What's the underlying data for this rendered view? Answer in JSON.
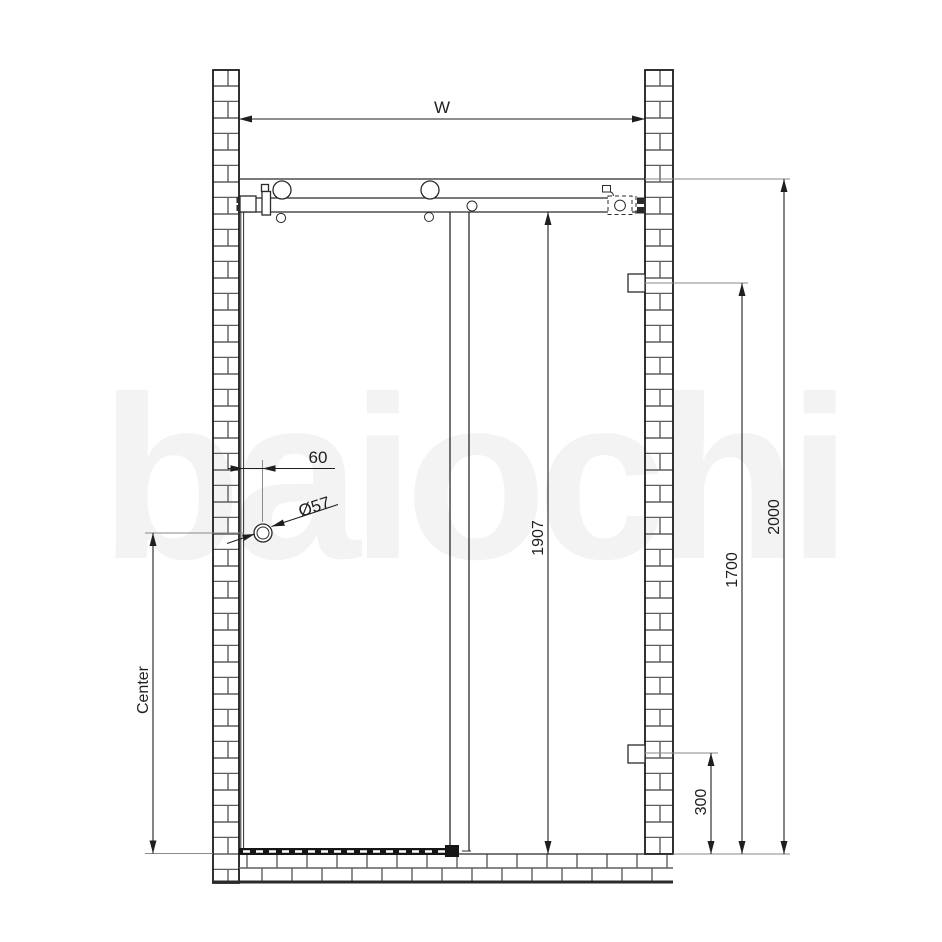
{
  "watermark": "baiochi",
  "labels": {
    "width": "W",
    "total_height": "2000",
    "glass_height": "1907",
    "bracket_height": "1700",
    "bracket_bottom_offset": "300",
    "handle_offset": "60",
    "handle_diameter": "Ø57",
    "handle_center": "Center"
  },
  "colors": {
    "line": "#1c1c1c",
    "draw": "#2b2b2b",
    "dim": "#1f1f1f",
    "ext": "#8a8a8a",
    "mortar": "#5f5f5f",
    "seal": "#161616",
    "watermark": "#f3f3f3"
  }
}
